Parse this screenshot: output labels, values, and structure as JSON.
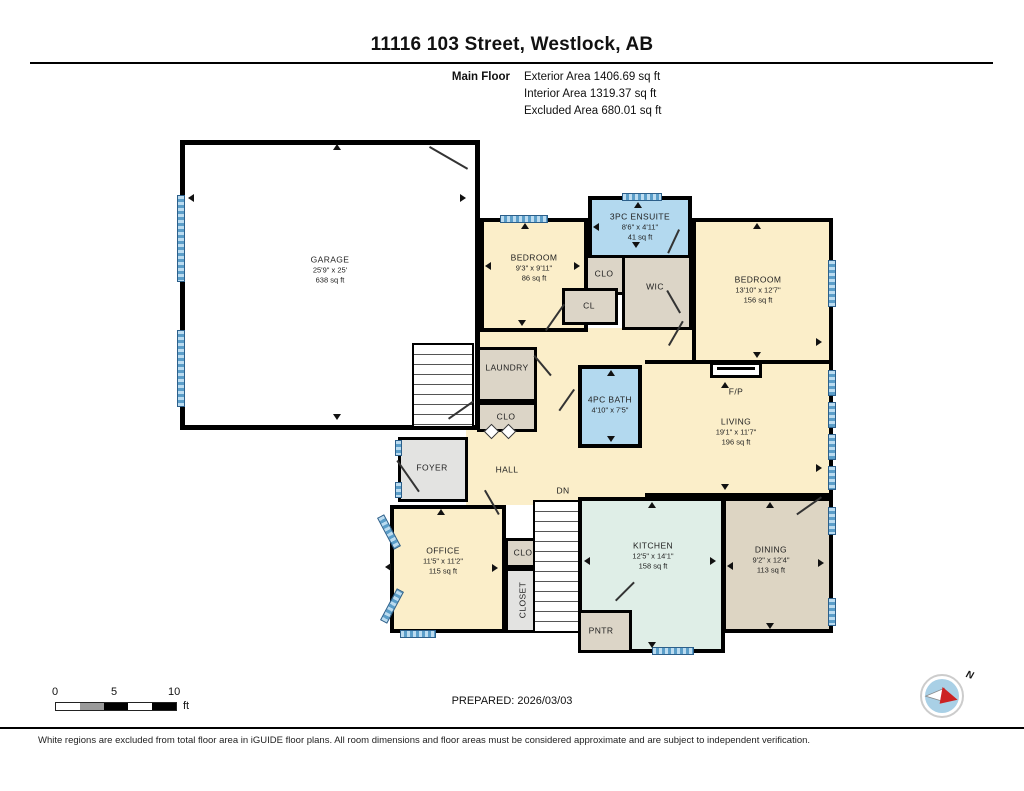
{
  "header": {
    "title": "11116 103 Street, Westlock, AB",
    "floor_label": "Main Floor",
    "stats": [
      "Exterior Area 1406.69 sq ft",
      "Interior Area 1319.37 sq ft",
      "Excluded Area 680.01 sq ft"
    ]
  },
  "rooms": {
    "garage": {
      "name": "GARAGE",
      "dims": "25'9\" x 25'",
      "area": "638 sq ft"
    },
    "bedroom_left": {
      "name": "BEDROOM",
      "dims": "9'3\" x 9'11\"",
      "area": "86 sq ft"
    },
    "ensuite": {
      "name": "3PC ENSUITE",
      "dims": "8'6\" x 4'11\"",
      "area": "41 sq ft"
    },
    "bedroom_right": {
      "name": "BEDROOM",
      "dims": "13'10\" x 12'7\"",
      "area": "156 sq ft"
    },
    "bath": {
      "name": "4PC BATH",
      "dims": "4'10\" x 7'5\""
    },
    "living": {
      "name": "LIVING",
      "dims": "19'1\" x 11'7\"",
      "area": "196 sq ft"
    },
    "office": {
      "name": "OFFICE",
      "dims": "11'5\" x 11'2\"",
      "area": "115 sq ft"
    },
    "kitchen": {
      "name": "KITCHEN",
      "dims": "12'5\" x 14'1\"",
      "area": "158 sq ft"
    },
    "dining": {
      "name": "DINING",
      "dims": "9'2\" x 12'4\"",
      "area": "113 sq ft"
    }
  },
  "labels": {
    "wic": "WIC",
    "clo": "CLO",
    "cl": "CL",
    "laundry": "LAUNDRY",
    "foyer": "FOYER",
    "hall": "HALL",
    "dn": "DN",
    "closet": "CLOSET",
    "pntr": "PNTR",
    "fp": "F/P"
  },
  "footer": {
    "prepared": "PREPARED: 2026/03/03",
    "scale_ticks": [
      "0",
      "5",
      "10"
    ],
    "scale_unit": "ft",
    "compass_label": "N",
    "disclaimer": "White regions are excluded from total floor area in iGUIDE floor plans. All room dimensions and floor areas must be considered approximate and are subject to independent verification."
  },
  "colors": {
    "cream": "#fbeec9",
    "bath_blue": "#b3d9ef",
    "closet_tan": "#dcd5c7",
    "kitchen_green": "#dfeee7",
    "dining_tan": "#ddd5c3",
    "foyer_gray": "#e3e3e1",
    "window_blue": "#5b9ec9",
    "wall": "#000000"
  }
}
